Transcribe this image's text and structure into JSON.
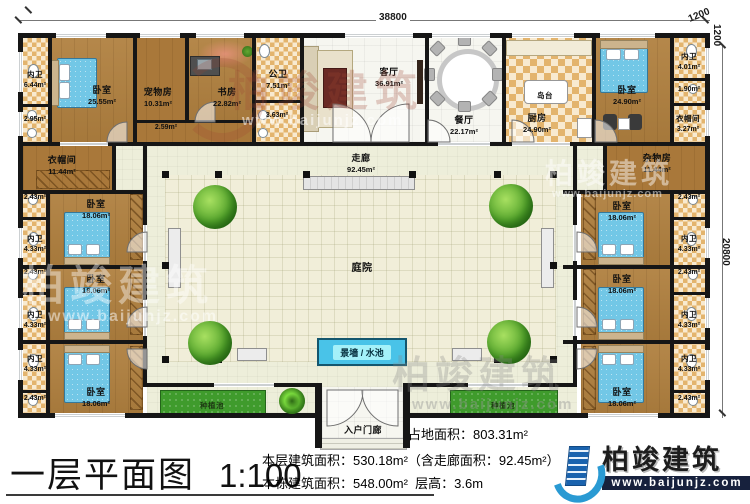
{
  "dimensions": {
    "top_width": "38800",
    "offset_h": "1200",
    "offset_v": "1200",
    "right_height": "20800"
  },
  "rooms": {
    "neiwei_644": {
      "name": "内卫",
      "area": "6.44m²"
    },
    "bath_295": {
      "area": "2.95m²"
    },
    "bedroom_2555": {
      "name": "卧室",
      "area": "25.55m²"
    },
    "pet_room": {
      "name": "宠物房",
      "area": "10.31m²"
    },
    "study": {
      "name": "书房",
      "area": "22.82m²"
    },
    "pass_259": {
      "area": "2.59m²"
    },
    "gongwei": {
      "name": "公卫",
      "area": "7.51m²"
    },
    "bath_363": {
      "area": "3.63m²"
    },
    "living": {
      "name": "客厅",
      "area": "36.91m²"
    },
    "dining": {
      "name": "餐厅",
      "area": "22.17m²"
    },
    "kitchen": {
      "name": "厨房",
      "area": "24.90m²"
    },
    "island": {
      "name": "岛台"
    },
    "bedroom_2490": {
      "name": "卧室",
      "area": "24.90m²"
    },
    "neiwei_401": {
      "name": "内卫",
      "area": "4.01m²"
    },
    "bath_190": {
      "area": "1.90m²"
    },
    "cloak_327": {
      "name": "衣帽间",
      "area": "3.27m²"
    },
    "storage": {
      "name": "杂物房",
      "area": "11.44m²"
    },
    "cloak_1144": {
      "name": "衣帽间",
      "area": "11.44m²"
    },
    "bedroom_1806": {
      "name": "卧室",
      "area": "18.06m²"
    },
    "neiwei_433": {
      "name": "内卫",
      "area": "4.33m²"
    },
    "bath_243": {
      "area": "2.43m²"
    },
    "corridor": {
      "name": "走廊",
      "area": "92.45m²"
    },
    "courtyard": {
      "name": "庭院"
    },
    "water_wall": {
      "name": "景墙 / 水池"
    },
    "planting": {
      "name": "种植池"
    },
    "entry_porch": {
      "name": "入户门廊"
    }
  },
  "footer": {
    "title": "一层平面图",
    "scale": "1:100",
    "land_area": "占地面积：803.31m²",
    "floor_area": "本层建筑面积：530.18m²（含走廊面积：92.45m²）",
    "building_area": "本栋建筑面积：548.00m²",
    "floor_height": "层高：3.6m"
  },
  "branding": {
    "logo_text": "柏竣建筑",
    "website": "www.baijunjz.com"
  }
}
